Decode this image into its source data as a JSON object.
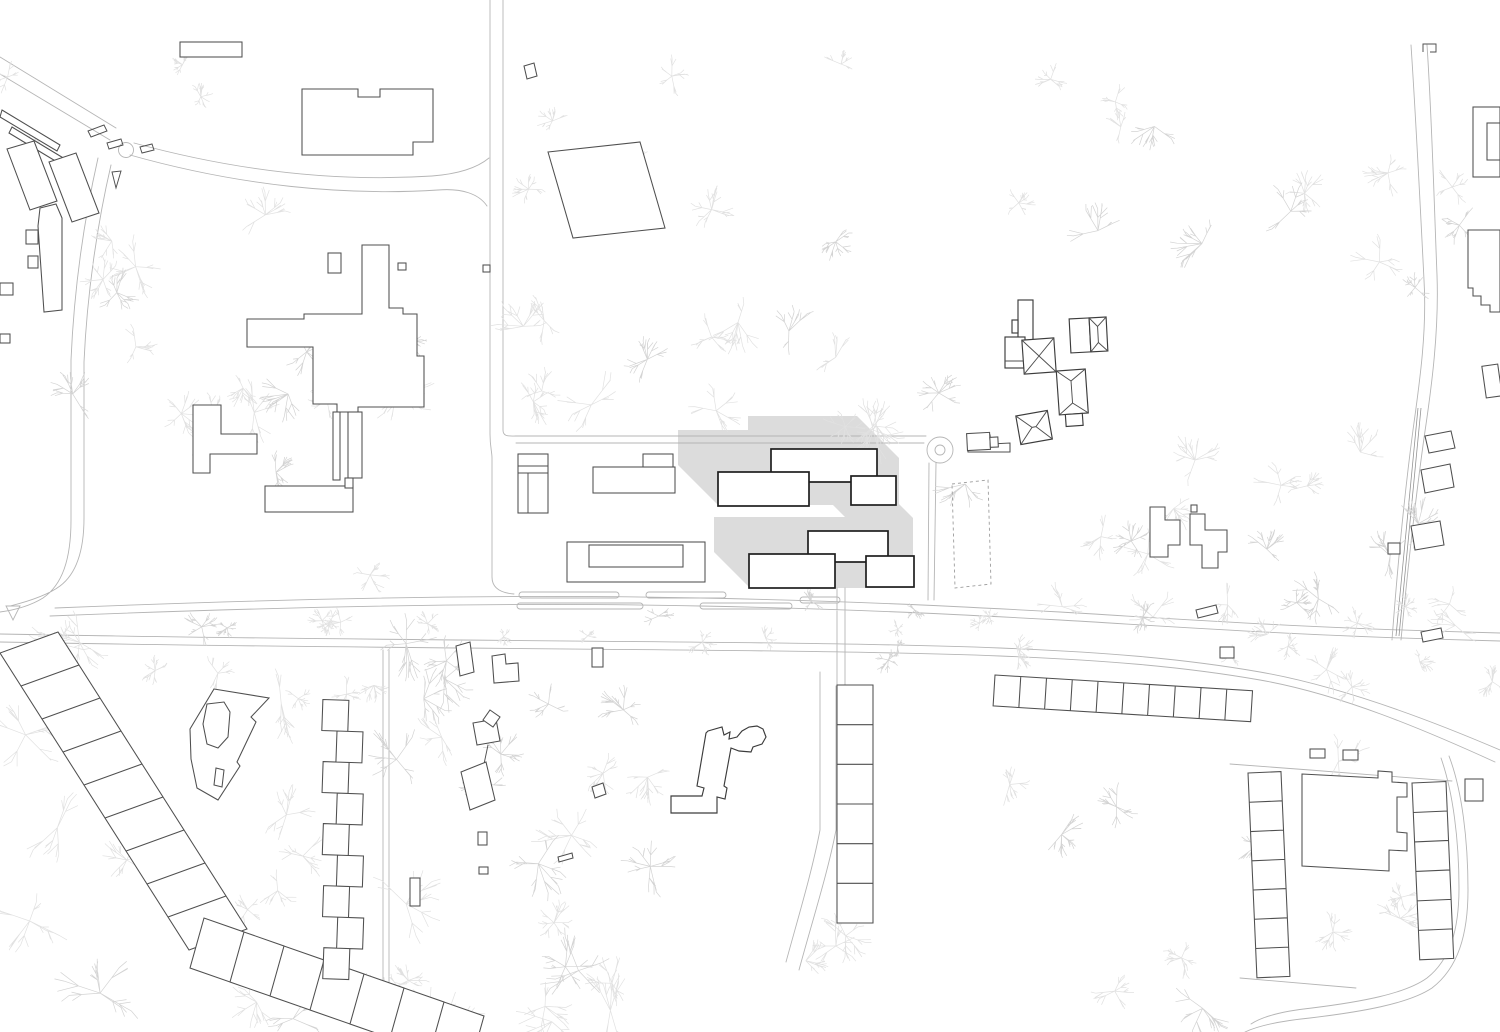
{
  "page": {
    "kind": "architectural-site-plan",
    "view": "top-down",
    "width_px": 1500,
    "height_px": 1032,
    "visible_text": "none"
  },
  "colors": {
    "background": "#ffffff",
    "building_fill": "#ffffff",
    "road_line": "#b5b5b5",
    "lane_line": "#949494",
    "existing_line": "#4f4f4f",
    "existing_dark": "#3c3c3c",
    "proposed_line": "#1e1e1e",
    "highlight_fill": "#dcdcdc",
    "tree_line": "#e1e1e1",
    "tree_line_2": "#d3d3d3",
    "dashed_line": "#9c9c9c"
  },
  "features": {
    "proposed_building_count": 6,
    "has_shadow_highlight_zone": true,
    "roundabout_present": true,
    "mini_roundabout_present": true,
    "dashed_sports_field_present": true,
    "garage_row_cells": 10,
    "south_terrace_cells": 6,
    "u_complex_left_cells": 7,
    "u_complex_right_cells": 6,
    "zipper_row_units": 9,
    "sawtooth_row1_units": 9,
    "sawtooth_row2_units": 7,
    "tree_regions": [
      [
        60,
        185,
        470,
        615,
        20,
        16,
        32
      ],
      [
        120,
        620,
        430,
        700,
        7,
        12,
        20
      ],
      [
        505,
        320,
        950,
        432,
        16,
        18,
        34
      ],
      [
        10,
        640,
        620,
        1025,
        24,
        20,
        40
      ],
      [
        430,
        650,
        1130,
        1015,
        18,
        16,
        34
      ],
      [
        950,
        60,
        1345,
        300,
        9,
        14,
        28
      ],
      [
        955,
        450,
        1335,
        625,
        13,
        16,
        30
      ],
      [
        1345,
        150,
        1480,
        630,
        10,
        14,
        26
      ],
      [
        1100,
        645,
        1500,
        1015,
        11,
        14,
        28
      ],
      [
        480,
        60,
        900,
        300,
        7,
        12,
        22
      ],
      [
        60,
        600,
        1450,
        662,
        26,
        8,
        16
      ],
      [
        0,
        60,
        210,
        140,
        4,
        10,
        18
      ],
      [
        230,
        860,
        430,
        1005,
        6,
        14,
        26
      ]
    ]
  }
}
